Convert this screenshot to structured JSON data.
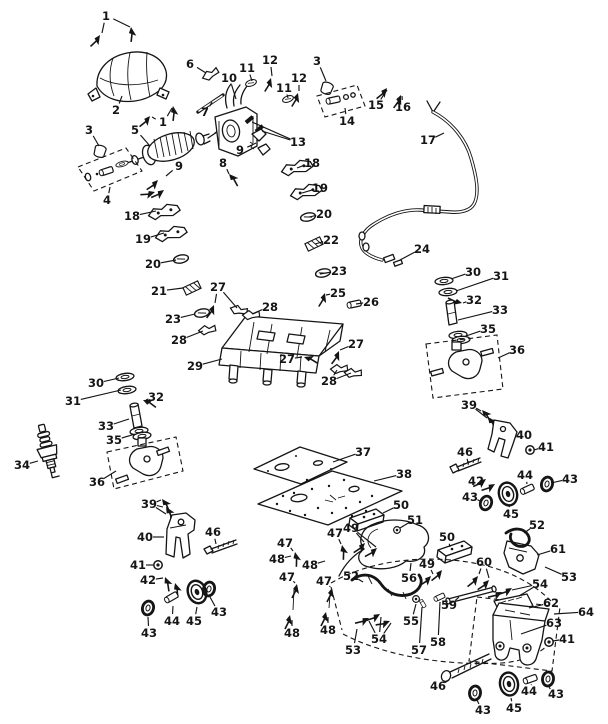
{
  "figure": {
    "type": "exploded_parts_diagram",
    "background": "#ffffff",
    "ink": "#151515",
    "width": 608,
    "height": 724,
    "part_numbers_visible": [
      "1",
      "2",
      "3",
      "4",
      "5",
      "6",
      "7",
      "8",
      "9",
      "10",
      "11",
      "12",
      "13",
      "14",
      "15",
      "16",
      "17",
      "18",
      "19",
      "20",
      "21",
      "22",
      "23",
      "24",
      "25",
      "26",
      "27",
      "28",
      "29",
      "30",
      "31",
      "32",
      "33",
      "34",
      "35",
      "36",
      "37",
      "38",
      "39",
      "40",
      "41",
      "42",
      "43",
      "44",
      "45",
      "46",
      "47",
      "48",
      "49",
      "50",
      "51",
      "52",
      "53",
      "54",
      "55",
      "56",
      "57",
      "58",
      "59",
      "60",
      "61",
      "62",
      "63",
      "64"
    ]
  },
  "callouts": [
    {
      "n": "1",
      "x": 106,
      "y": 16,
      "leads": [
        [
          102,
          33
        ],
        [
          130,
          27
        ]
      ]
    },
    {
      "n": "2",
      "x": 116,
      "y": 110,
      "leads": [
        [
          122,
          96
        ]
      ]
    },
    {
      "n": "3",
      "x": 89,
      "y": 130,
      "leads": [
        [
          99,
          146
        ]
      ]
    },
    {
      "n": "5",
      "x": 135,
      "y": 130,
      "leads": [
        [
          150,
          146
        ]
      ]
    },
    {
      "n": "1",
      "x": 163,
      "y": 122,
      "leads": [
        [
          152,
          117
        ],
        [
          172,
          108
        ]
      ]
    },
    {
      "n": "4",
      "x": 107,
      "y": 200,
      "leads": [
        [
          110,
          187
        ]
      ]
    },
    {
      "n": "6",
      "x": 190,
      "y": 64,
      "leads": [
        [
          206,
          73
        ]
      ]
    },
    {
      "n": "7",
      "x": 205,
      "y": 112,
      "leads": [
        [
          212,
          102
        ]
      ]
    },
    {
      "n": "10",
      "x": 229,
      "y": 78,
      "leads": [
        [
          236,
          99
        ]
      ]
    },
    {
      "n": "11",
      "x": 247,
      "y": 68,
      "leads": [
        [
          252,
          81
        ]
      ]
    },
    {
      "n": "12",
      "x": 270,
      "y": 60,
      "leads": [
        [
          272,
          76
        ]
      ]
    },
    {
      "n": "11",
      "x": 284,
      "y": 88,
      "leads": [
        [
          288,
          98
        ]
      ]
    },
    {
      "n": "12",
      "x": 299,
      "y": 78,
      "leads": [
        [
          299,
          91
        ]
      ]
    },
    {
      "n": "3",
      "x": 317,
      "y": 61,
      "leads": [
        [
          326,
          81
        ]
      ]
    },
    {
      "n": "13",
      "x": 298,
      "y": 142,
      "leads": [
        [
          252,
          122
        ],
        [
          262,
          131
        ]
      ]
    },
    {
      "n": "9",
      "x": 240,
      "y": 150,
      "leads": [
        [
          256,
          143
        ]
      ]
    },
    {
      "n": "8",
      "x": 223,
      "y": 163,
      "leads": [
        [
          229,
          174
        ]
      ]
    },
    {
      "n": "9",
      "x": 179,
      "y": 166,
      "leads": [
        [
          166,
          176
        ]
      ]
    },
    {
      "n": "14",
      "x": 347,
      "y": 121,
      "leads": [
        [
          345,
          108
        ]
      ]
    },
    {
      "n": "15",
      "x": 376,
      "y": 105,
      "leads": [
        [
          387,
          90
        ]
      ]
    },
    {
      "n": "16",
      "x": 403,
      "y": 107,
      "leads": [
        [
          402,
          96
        ]
      ]
    },
    {
      "n": "17",
      "x": 428,
      "y": 140,
      "leads": [
        [
          444,
          133
        ]
      ]
    },
    {
      "n": "18",
      "x": 132,
      "y": 216,
      "leads": [
        [
          156,
          211
        ]
      ]
    },
    {
      "n": "18",
      "x": 312,
      "y": 163,
      "leads": [
        [
          297,
          168
        ]
      ]
    },
    {
      "n": "19",
      "x": 143,
      "y": 239,
      "leads": [
        [
          164,
          233
        ]
      ]
    },
    {
      "n": "19",
      "x": 320,
      "y": 188,
      "leads": [
        [
          302,
          193
        ]
      ]
    },
    {
      "n": "20",
      "x": 153,
      "y": 264,
      "leads": [
        [
          176,
          260
        ]
      ]
    },
    {
      "n": "20",
      "x": 324,
      "y": 214,
      "leads": [
        [
          309,
          217
        ]
      ]
    },
    {
      "n": "21",
      "x": 159,
      "y": 291,
      "leads": [
        [
          183,
          288
        ]
      ]
    },
    {
      "n": "22",
      "x": 331,
      "y": 240,
      "leads": [
        [
          315,
          244
        ]
      ]
    },
    {
      "n": "23",
      "x": 173,
      "y": 319,
      "leads": [
        [
          195,
          314
        ]
      ]
    },
    {
      "n": "23",
      "x": 339,
      "y": 271,
      "leads": [
        [
          320,
          274
        ]
      ]
    },
    {
      "n": "25",
      "x": 338,
      "y": 293,
      "leads": [
        [
          326,
          295
        ]
      ]
    },
    {
      "n": "26",
      "x": 371,
      "y": 302,
      "leads": [
        [
          356,
          304
        ]
      ]
    },
    {
      "n": "27",
      "x": 218,
      "y": 287,
      "leads": [
        [
          215,
          303
        ],
        [
          237,
          308
        ]
      ]
    },
    {
      "n": "28",
      "x": 270,
      "y": 307,
      "leads": [
        [
          252,
          314
        ]
      ]
    },
    {
      "n": "28",
      "x": 179,
      "y": 340,
      "leads": [
        [
          203,
          331
        ]
      ]
    },
    {
      "n": "29",
      "x": 195,
      "y": 366,
      "leads": [
        [
          222,
          359
        ]
      ]
    },
    {
      "n": "27",
      "x": 356,
      "y": 344,
      "leads": [
        [
          340,
          350
        ]
      ]
    },
    {
      "n": "27",
      "x": 287,
      "y": 359,
      "leads": [
        [
          302,
          357
        ]
      ]
    },
    {
      "n": "28",
      "x": 329,
      "y": 381,
      "leads": [
        [
          337,
          370
        ],
        [
          351,
          373
        ]
      ]
    },
    {
      "n": "24",
      "x": 422,
      "y": 249,
      "leads": [
        [
          400,
          260
        ]
      ]
    },
    {
      "n": "30",
      "x": 473,
      "y": 272,
      "leads": [
        [
          451,
          279
        ]
      ]
    },
    {
      "n": "31",
      "x": 501,
      "y": 276,
      "leads": [
        [
          456,
          291
        ]
      ]
    },
    {
      "n": "32",
      "x": 474,
      "y": 300,
      "leads": [
        [
          463,
          303
        ]
      ]
    },
    {
      "n": "33",
      "x": 500,
      "y": 310,
      "leads": [
        [
          458,
          320
        ]
      ]
    },
    {
      "n": "35",
      "x": 488,
      "y": 329,
      "leads": [
        [
          466,
          336
        ]
      ]
    },
    {
      "n": "36",
      "x": 517,
      "y": 350,
      "leads": [
        [
          498,
          358
        ]
      ]
    },
    {
      "n": "30",
      "x": 96,
      "y": 383,
      "leads": [
        [
          119,
          378
        ]
      ]
    },
    {
      "n": "31",
      "x": 73,
      "y": 401,
      "leads": [
        [
          121,
          390
        ]
      ]
    },
    {
      "n": "32",
      "x": 156,
      "y": 397,
      "leads": [
        [
          146,
          400
        ]
      ]
    },
    {
      "n": "33",
      "x": 106,
      "y": 426,
      "leads": [
        [
          129,
          419
        ]
      ]
    },
    {
      "n": "35",
      "x": 114,
      "y": 440,
      "leads": [
        [
          135,
          434
        ]
      ]
    },
    {
      "n": "34",
      "x": 22,
      "y": 465,
      "leads": [
        [
          38,
          461
        ]
      ]
    },
    {
      "n": "36",
      "x": 97,
      "y": 482,
      "leads": [
        [
          116,
          471
        ]
      ]
    },
    {
      "n": "37",
      "x": 363,
      "y": 452,
      "leads": [
        [
          333,
          462
        ]
      ]
    },
    {
      "n": "38",
      "x": 404,
      "y": 474,
      "leads": [
        [
          374,
          481
        ]
      ]
    },
    {
      "n": "39",
      "x": 149,
      "y": 504,
      "leads": [
        [
          161,
          500
        ],
        [
          163,
          507
        ],
        [
          166,
          514
        ]
      ]
    },
    {
      "n": "40",
      "x": 145,
      "y": 537,
      "leads": [
        [
          164,
          537
        ]
      ]
    },
    {
      "n": "46",
      "x": 213,
      "y": 532,
      "leads": [
        [
          216,
          544
        ]
      ]
    },
    {
      "n": "41",
      "x": 138,
      "y": 565,
      "leads": [
        [
          153,
          565
        ]
      ]
    },
    {
      "n": "42",
      "x": 148,
      "y": 580,
      "leads": [
        [
          163,
          578
        ]
      ]
    },
    {
      "n": "43",
      "x": 149,
      "y": 633,
      "leads": [
        [
          148,
          617
        ]
      ]
    },
    {
      "n": "44",
      "x": 172,
      "y": 621,
      "leads": [
        [
          173,
          606
        ]
      ]
    },
    {
      "n": "45",
      "x": 194,
      "y": 621,
      "leads": [
        [
          197,
          607
        ]
      ]
    },
    {
      "n": "43",
      "x": 219,
      "y": 612,
      "leads": [
        [
          210,
          597
        ]
      ]
    },
    {
      "n": "39",
      "x": 469,
      "y": 405,
      "leads": [
        [
          481,
          411
        ],
        [
          487,
          418
        ]
      ]
    },
    {
      "n": "40",
      "x": 524,
      "y": 435,
      "leads": [
        [
          516,
          437
        ]
      ]
    },
    {
      "n": "41",
      "x": 546,
      "y": 447,
      "leads": [
        [
          534,
          450
        ]
      ]
    },
    {
      "n": "46",
      "x": 465,
      "y": 452,
      "leads": [
        [
          468,
          463
        ]
      ]
    },
    {
      "n": "42",
      "x": 476,
      "y": 481,
      "leads": [
        [
          484,
          480
        ]
      ]
    },
    {
      "n": "44",
      "x": 525,
      "y": 475,
      "leads": [
        [
          527,
          484
        ]
      ]
    },
    {
      "n": "43",
      "x": 570,
      "y": 479,
      "leads": [
        [
          551,
          483
        ]
      ]
    },
    {
      "n": "43",
      "x": 470,
      "y": 497,
      "leads": [
        [
          480,
          501
        ]
      ]
    },
    {
      "n": "45",
      "x": 511,
      "y": 514,
      "leads": [
        [
          509,
          505
        ]
      ]
    },
    {
      "n": "49",
      "x": 351,
      "y": 528,
      "leads": [
        [
          364,
          542
        ],
        [
          376,
          547
        ]
      ]
    },
    {
      "n": "50",
      "x": 401,
      "y": 505,
      "leads": [
        [
          383,
          513
        ]
      ]
    },
    {
      "n": "51",
      "x": 415,
      "y": 520,
      "leads": [
        [
          400,
          528
        ]
      ]
    },
    {
      "n": "50",
      "x": 447,
      "y": 537,
      "leads": [
        [
          450,
          547
        ]
      ]
    },
    {
      "n": "47",
      "x": 335,
      "y": 533,
      "leads": [
        [
          341,
          544
        ]
      ]
    },
    {
      "n": "47",
      "x": 285,
      "y": 543,
      "leads": [
        [
          293,
          551
        ]
      ]
    },
    {
      "n": "48",
      "x": 277,
      "y": 559,
      "leads": [
        [
          291,
          556
        ]
      ]
    },
    {
      "n": "48",
      "x": 310,
      "y": 565,
      "leads": [
        [
          325,
          561
        ]
      ]
    },
    {
      "n": "47",
      "x": 287,
      "y": 577,
      "leads": [
        [
          295,
          583
        ]
      ]
    },
    {
      "n": "47",
      "x": 324,
      "y": 581,
      "leads": [
        [
          330,
          587
        ]
      ]
    },
    {
      "n": "48",
      "x": 292,
      "y": 633,
      "leads": [
        [
          292,
          620
        ]
      ]
    },
    {
      "n": "48",
      "x": 328,
      "y": 630,
      "leads": [
        [
          328,
          617
        ]
      ]
    },
    {
      "n": "52",
      "x": 351,
      "y": 576,
      "leads": [
        [
          363,
          582
        ]
      ]
    },
    {
      "n": "56",
      "x": 409,
      "y": 578,
      "leads": [
        [
          411,
          563
        ]
      ]
    },
    {
      "n": "49",
      "x": 427,
      "y": 564,
      "leads": [
        [
          433,
          574
        ]
      ]
    },
    {
      "n": "53",
      "x": 353,
      "y": 650,
      "leads": [
        [
          357,
          629
        ]
      ]
    },
    {
      "n": "54",
      "x": 379,
      "y": 639,
      "leads": [
        [
          369,
          621
        ],
        [
          381,
          617
        ],
        [
          391,
          623
        ]
      ]
    },
    {
      "n": "55",
      "x": 411,
      "y": 621,
      "leads": [
        [
          416,
          604
        ]
      ]
    },
    {
      "n": "57",
      "x": 419,
      "y": 650,
      "leads": [
        [
          422,
          607
        ]
      ]
    },
    {
      "n": "58",
      "x": 438,
      "y": 642,
      "leads": [
        [
          440,
          602
        ]
      ]
    },
    {
      "n": "59",
      "x": 449,
      "y": 605,
      "leads": [
        [
          459,
          597
        ]
      ]
    },
    {
      "n": "60",
      "x": 484,
      "y": 562,
      "leads": [
        [
          479,
          574
        ],
        [
          489,
          578
        ]
      ]
    },
    {
      "n": "52",
      "x": 537,
      "y": 525,
      "leads": [
        [
          524,
          533
        ]
      ]
    },
    {
      "n": "61",
      "x": 558,
      "y": 549,
      "leads": [
        [
          537,
          555
        ]
      ]
    },
    {
      "n": "53",
      "x": 569,
      "y": 577,
      "leads": [
        [
          545,
          567
        ]
      ]
    },
    {
      "n": "54",
      "x": 540,
      "y": 584,
      "leads": [
        [
          512,
          590
        ],
        [
          519,
          596
        ]
      ]
    },
    {
      "n": "62",
      "x": 551,
      "y": 603,
      "leads": [
        [
          529,
          608
        ]
      ]
    },
    {
      "n": "64",
      "x": 586,
      "y": 612,
      "leads": [
        [
          554,
          614
        ]
      ]
    },
    {
      "n": "63",
      "x": 554,
      "y": 623,
      "leads": [
        [
          521,
          634
        ]
      ]
    },
    {
      "n": "41",
      "x": 567,
      "y": 639,
      "leads": [
        [
          553,
          641
        ]
      ]
    },
    {
      "n": "46",
      "x": 438,
      "y": 686,
      "leads": [
        [
          449,
          680
        ]
      ]
    },
    {
      "n": "43",
      "x": 556,
      "y": 694,
      "leads": [
        [
          549,
          687
        ]
      ]
    },
    {
      "n": "44",
      "x": 529,
      "y": 691,
      "leads": [
        [
          531,
          685
        ]
      ]
    },
    {
      "n": "45",
      "x": 514,
      "y": 708,
      "leads": [
        [
          511,
          698
        ]
      ]
    },
    {
      "n": "43",
      "x": 483,
      "y": 710,
      "leads": [
        [
          477,
          700
        ]
      ]
    }
  ]
}
